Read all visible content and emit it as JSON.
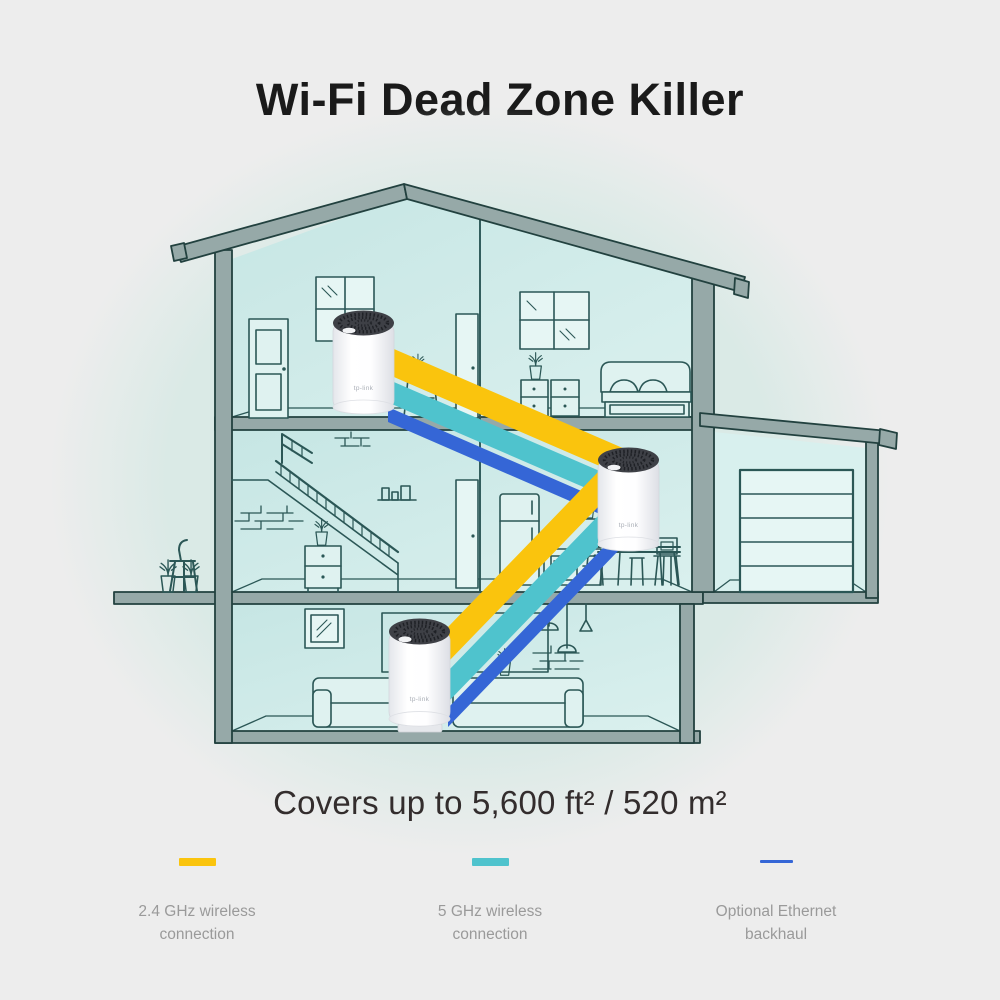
{
  "title": "Wi-Fi Dead Zone Killer",
  "coverage_text": "Covers up to 5,600 ft² / 520 m²",
  "device": {
    "brand": "tp-link",
    "count": 3
  },
  "legend": [
    {
      "label": "2.4 GHz wireless connection",
      "color": "#FAC40D",
      "swatch": "thick-dash"
    },
    {
      "label": "5 GHz wireless connection",
      "color": "#4FC3CD",
      "swatch": "thick-dash"
    },
    {
      "label": "Optional Ethernet backhaul",
      "color": "#3566D6",
      "swatch": "thin-line"
    }
  ],
  "colors": {
    "background": "#EDEDED",
    "blob": "#DAEAE6",
    "band_yellow": "#FAC40D",
    "band_teal": "#4FC3CD",
    "band_blue": "#3566D6",
    "house_line": "#2B5756",
    "structure_fill": "#96A9A8",
    "room_fill": "#CDE9E7",
    "title_text": "#1A1A1A",
    "coverage_text": "#332D2D",
    "legend_text": "#9A9A9A",
    "device_cap": "#3E4046",
    "device_body": "#FFFFFF"
  }
}
